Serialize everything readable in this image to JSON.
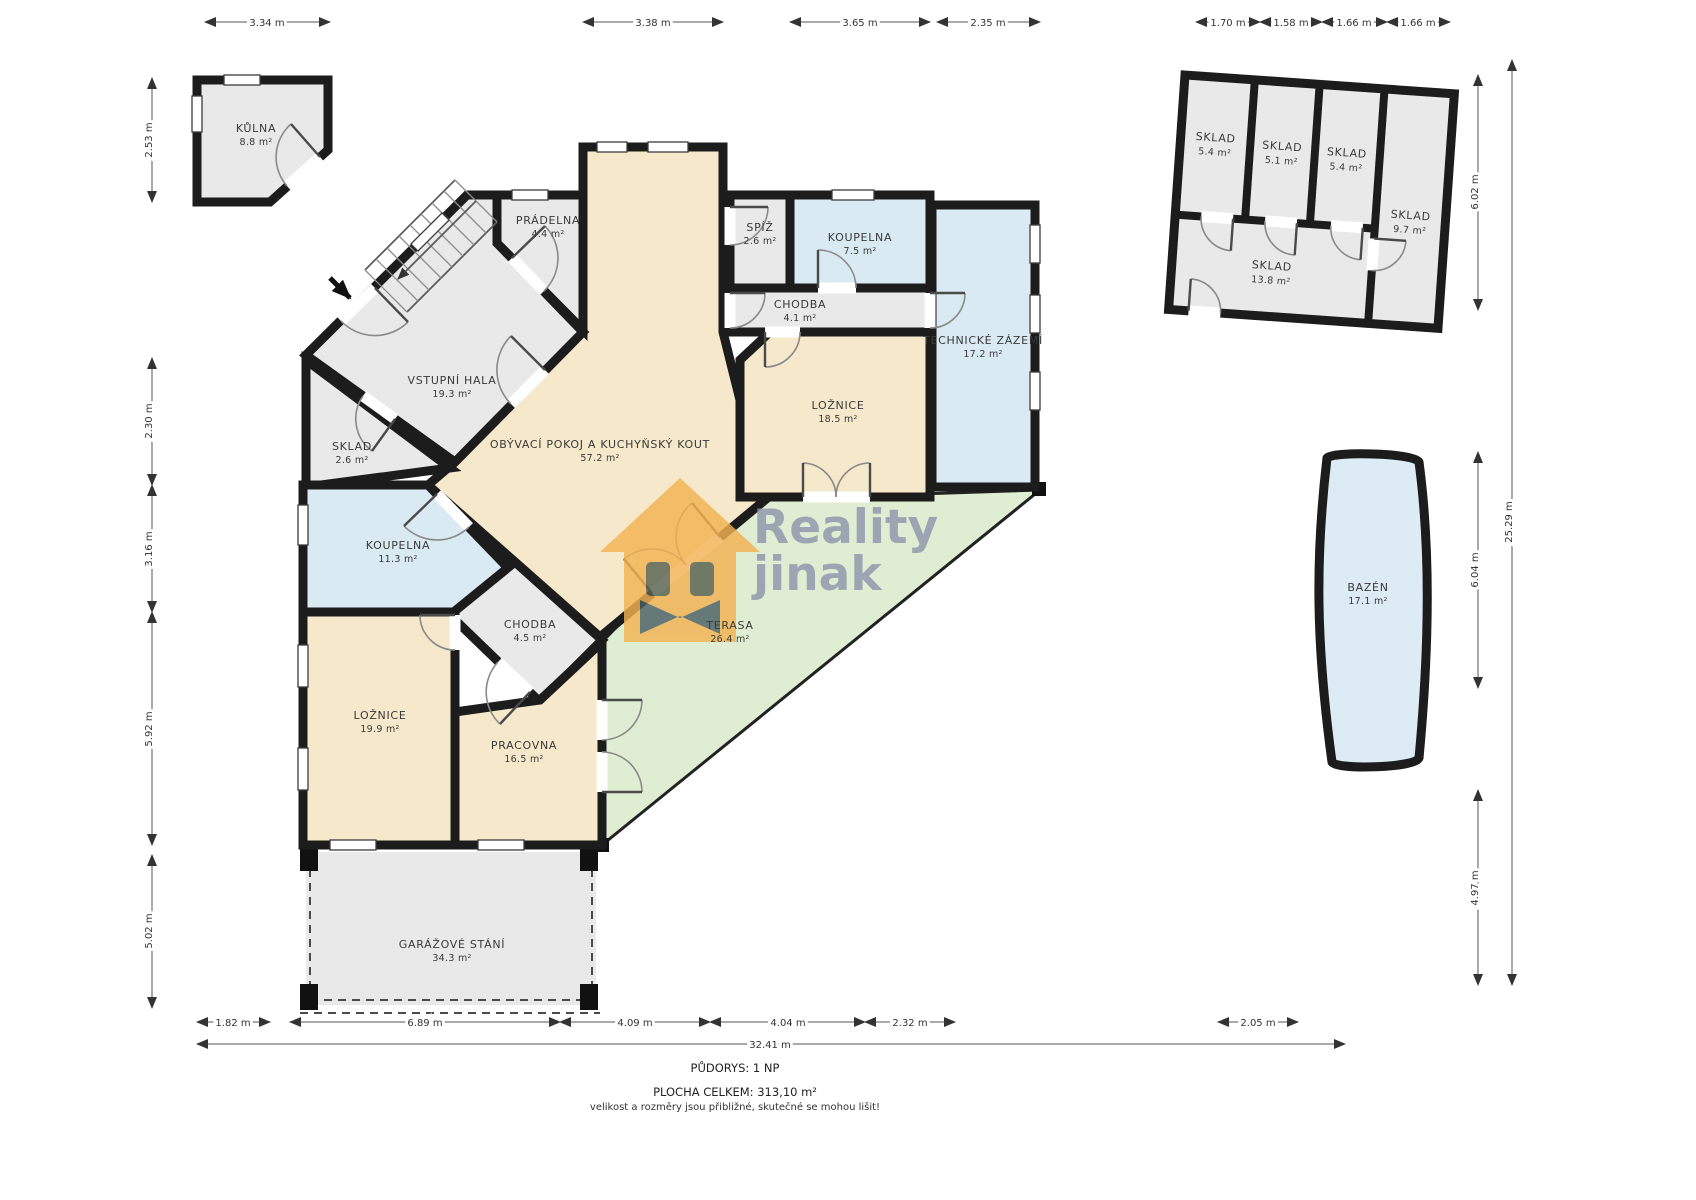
{
  "rooms": {
    "kulna": {
      "name": "KŮLNA",
      "area": "8.8 m²"
    },
    "vstupni_hala": {
      "name": "VSTUPNÍ HALA",
      "area": "19.3 m²"
    },
    "pradelna": {
      "name": "PRÁDELNA",
      "area": "4.4 m²"
    },
    "sklad_maly": {
      "name": "SKLAD",
      "area": "2.6 m²"
    },
    "koupelna_velka": {
      "name": "KOUPELNA",
      "area": "11.3 m²"
    },
    "chodba_jih": {
      "name": "CHODBA",
      "area": "4.5 m²"
    },
    "loznice_velka": {
      "name": "LOŽNICE",
      "area": "19.9 m²"
    },
    "pracovna": {
      "name": "PRACOVNA",
      "area": "16.5 m²"
    },
    "obyvaci": {
      "name": "OBÝVACÍ POKOJ A KUCHYŇSKÝ KOUT",
      "area": "57.2 m²"
    },
    "spiz": {
      "name": "SPÍŽ",
      "area": "2.6 m²"
    },
    "koupelna_mala": {
      "name": "KOUPELNA",
      "area": "7.5 m²"
    },
    "chodba_sever": {
      "name": "CHODBA",
      "area": "4.1 m²"
    },
    "loznice_mala": {
      "name": "LOŽNICE",
      "area": "18.5 m²"
    },
    "technicke": {
      "name": "TECHNICKÉ ZÁZEMÍ",
      "area": "17.2 m²"
    },
    "terasa": {
      "name": "TERASA",
      "area": "26.4 m²"
    },
    "garaz": {
      "name": "GARÁŽOVÉ STÁNÍ",
      "area": "34.3 m²"
    },
    "bazen": {
      "name": "BAZÉN",
      "area": "17.1 m²"
    },
    "sklad_a": {
      "name": "SKLAD",
      "area": "5.4 m²"
    },
    "sklad_b": {
      "name": "SKLAD",
      "area": "5.1 m²"
    },
    "sklad_c": {
      "name": "SKLAD",
      "area": "5.4 m²"
    },
    "sklad_d": {
      "name": "SKLAD",
      "area": "9.7 m²"
    },
    "sklad_e": {
      "name": "SKLAD",
      "area": "13.8 m²"
    }
  },
  "dims": {
    "top": [
      "3.34 m",
      "3.38 m",
      "3.65 m",
      "2.35 m",
      "1.70 m",
      "1.58 m",
      "1.66 m",
      "1.66 m"
    ],
    "left": [
      "2.53 m",
      "2.30 m",
      "3.16 m",
      "5.92 m",
      "5.02 m"
    ],
    "right": [
      "6.02 m",
      "6.04 m",
      "4.97 m",
      "25.29 m"
    ],
    "bottom": [
      "1.82 m",
      "6.89 m",
      "4.09 m",
      "4.04 m",
      "2.32 m",
      "2.05 m",
      "32.41 m"
    ]
  },
  "footer": {
    "plan": "PŮDORYS: 1 NP",
    "total": "PLOCHA CELKEM:  313,10 m²",
    "note": "velikost a rozměry jsou přibližné, skutečné se mohou lišit!"
  },
  "watermark": {
    "word1": "Reality",
    "word2": "jinak"
  },
  "colors": {
    "wall": "#1c1c1c",
    "beige": "#f6e8ca",
    "blue": "#d9eaf2",
    "gray": "#e9e9e9",
    "green": "#dfeed2",
    "pool": "#dcebf4",
    "orange": "#f3b352",
    "wm_text": "#8d97ac",
    "eye": "#57614e",
    "bowtie": "#4b6066"
  }
}
